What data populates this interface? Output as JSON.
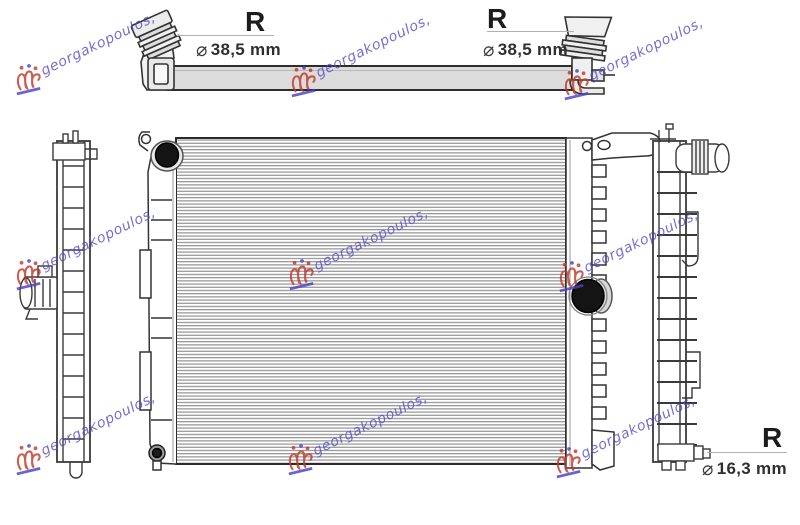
{
  "watermark": {
    "text": "georgakopoulos,",
    "text_color": "#564ec4",
    "logo_color": "#c03a2b"
  },
  "annotations": {
    "top_left": {
      "label": "R",
      "diameter_symbol": "⌀",
      "value": "38,5 mm"
    },
    "top_right": {
      "label": "R",
      "diameter_symbol": "⌀",
      "value": "38,5 mm"
    },
    "bottom_right": {
      "label": "R",
      "diameter_symbol": "⌀",
      "value": "16,3 mm"
    }
  },
  "colors": {
    "line": "#333333",
    "bar_fill": "#dcdcdc",
    "port_black": "#141414",
    "background": "#ffffff"
  }
}
